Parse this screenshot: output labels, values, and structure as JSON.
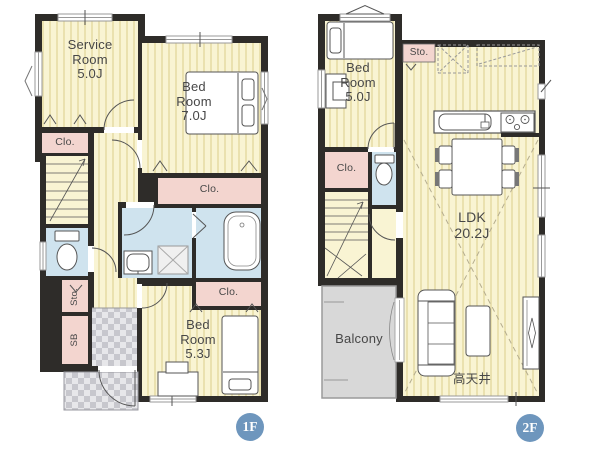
{
  "floor1": {
    "badge": "1F",
    "labels": {
      "service_room": "Service\nRoom\n5.0J",
      "bedroom_7": "Bed\nRoom\n7.0J",
      "bedroom_53": "Bed\nRoom\n5.3J",
      "closet_service": "Clo.",
      "closet_bedroom7": "Clo.",
      "closet_bath": "Clo.",
      "storage": "Sto.",
      "shoe_box": "SB"
    }
  },
  "floor2": {
    "badge": "2F",
    "labels": {
      "bedroom_5": "Bed\nRoom\n5.0J",
      "ldk": "LDK\n20.2J",
      "balcony": "Balcony",
      "storage": "Sto.",
      "closet": "Clo.",
      "high_ceiling": "高天井"
    }
  },
  "colors": {
    "wall": "#2e2c29",
    "floor": "#f9f4d3",
    "stripe": "#eae1af",
    "closet": "#f3d5cf",
    "wet": "#cfe3ee",
    "tile_dark": "#c7c7cd",
    "tile_light": "#e7e7ea",
    "balcony": "#d8d8d8",
    "badge": "#6e96bd",
    "text": "#474747"
  }
}
